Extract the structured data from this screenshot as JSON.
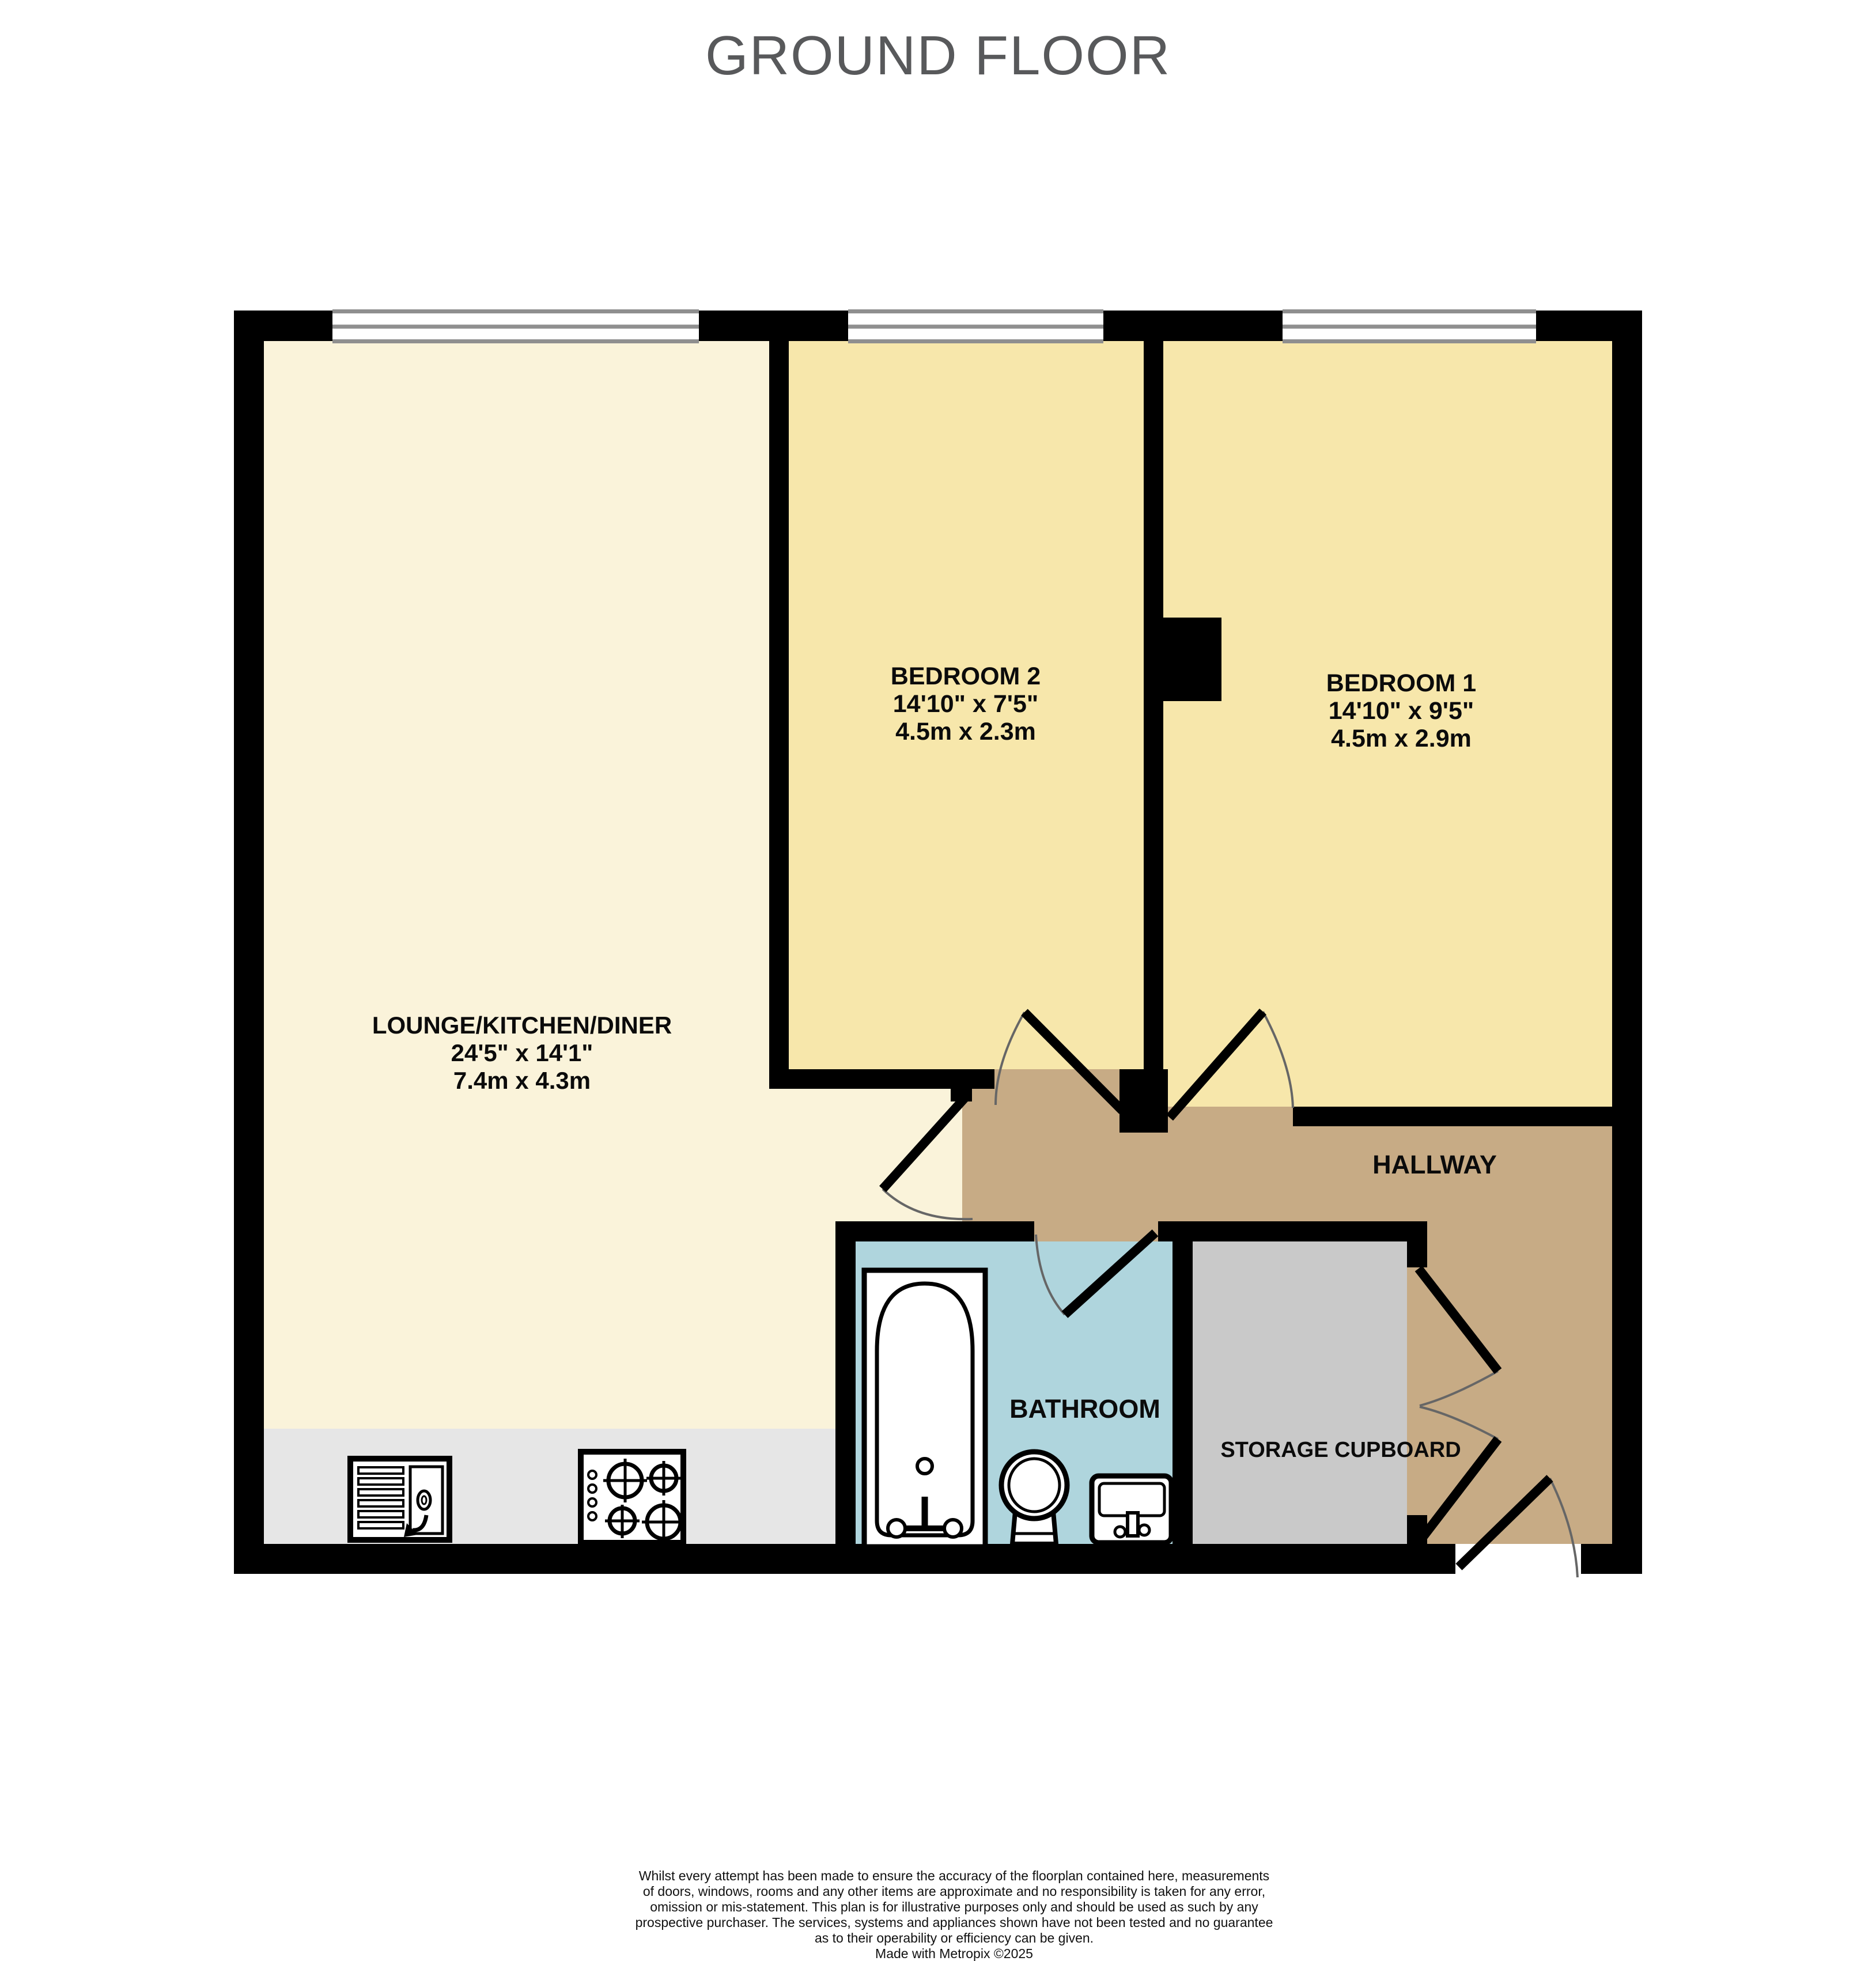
{
  "title": "GROUND FLOOR",
  "rooms": {
    "lounge": {
      "name": "LOUNGE/KITCHEN/DINER",
      "size_imperial": "24'5\" x 14'1\"",
      "size_metric": "7.4m x 4.3m",
      "color": "#faf3da"
    },
    "bedroom2": {
      "name": "BEDROOM 2",
      "size_imperial": "14'10\" x 7'5\"",
      "size_metric": "4.5m x 2.3m",
      "color": "#f7e7ab"
    },
    "bedroom1": {
      "name": "BEDROOM 1",
      "size_imperial": "14'10\" x 9'5\"",
      "size_metric": "4.5m x 2.9m",
      "color": "#f7e7ab"
    },
    "hallway": {
      "name": "HALLWAY",
      "color": "#c7ab85"
    },
    "bathroom": {
      "name": "BATHROOM",
      "color": "#afd5dd"
    },
    "storage": {
      "name": "STORAGE CUPBOARD",
      "color": "#c9c9c9"
    }
  },
  "fixtures": [
    "bathtub",
    "toilet",
    "basin",
    "kitchen-sink",
    "hob"
  ],
  "colors": {
    "walls": "#000000",
    "counter": "#e6e6e6",
    "title_text": "#58595b",
    "window_frame": "#8f8f8f",
    "door_arc": "#666666"
  },
  "disclaimer": {
    "lines": [
      "Whilst every attempt has been made to ensure the accuracy of the floorplan contained here, measurements",
      "of doors, windows, rooms and any other items are approximate and no responsibility is taken for any error,",
      "omission or mis-statement. This plan is for illustrative purposes only and should be used as such by any",
      "prospective purchaser. The services, systems and appliances shown have not been tested and no guarantee",
      "as to their operability or efficiency can be given."
    ],
    "credit": "Made with Metropix ©2025"
  }
}
